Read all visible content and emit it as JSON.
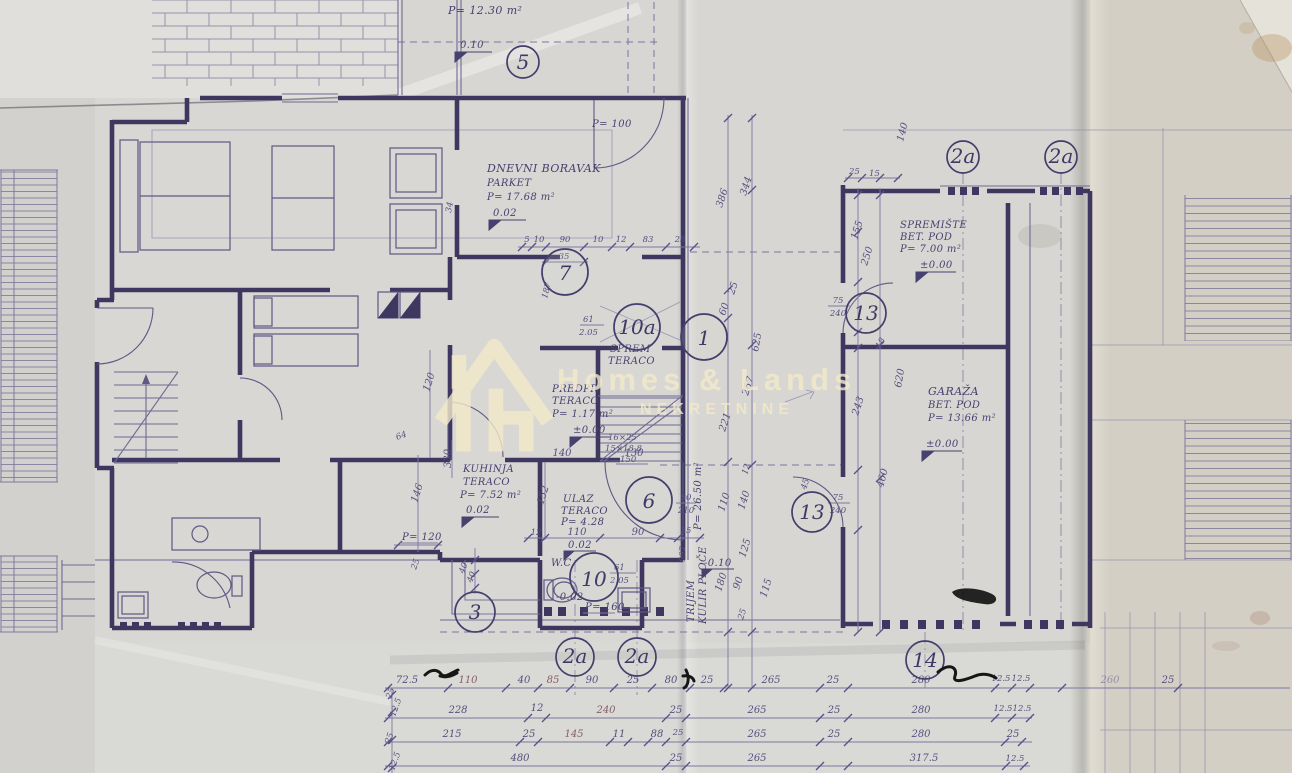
{
  "watermark": {
    "brand": "Homes & Lands",
    "subtitle": "NEKRETNINE",
    "color": "#f3eaca"
  },
  "plan": {
    "ink_color": "#3e3860",
    "paper_color": "#d7d6d2"
  },
  "rooms": {
    "attic": {
      "area": "P= 12.30 m²",
      "elev": "0.10"
    },
    "dnevni": {
      "name": "DNEVNI BORAVAK",
      "floor": "PARKET",
      "area": "P= 17.68 m²",
      "elev": "0.02",
      "note": "P= 100"
    },
    "sprem": {
      "name": "SPREM",
      "floor": "TERACO"
    },
    "predpr": {
      "name": "PREDPR",
      "floor": "TERACO",
      "area": "P= 1.17 m²",
      "elev": "±0.00"
    },
    "kuhinja": {
      "name": "KUHINJA",
      "floor": "TERACO",
      "area": "P= 7.52 m²",
      "elev": "0.02"
    },
    "ulaz": {
      "name": "ULAZ",
      "floor": "TERACO",
      "area": "P= 4.28",
      "elev": "0.02"
    },
    "wc": {
      "name": "W.C.",
      "elev": "-0.02",
      "door_w": "61",
      "door_h": "2.05",
      "note": "P= 160"
    },
    "trijem": {
      "name": "TRIJEM",
      "floor": "KULIR PLOČE",
      "area": "P= 26.50 m²",
      "elev": "-0.10"
    },
    "spremiste": {
      "name": "SPREMIŠTE",
      "floor": "BET. POD",
      "area": "P= 7.00 m²",
      "elev": "±0.00"
    },
    "garaza": {
      "name": "GARAŽA",
      "floor": "BET. POD",
      "area": "P= 13.66 m²",
      "elev": "±0.00"
    },
    "stairs": {
      "steps1": "16×25",
      "steps2": "15×18.8",
      "width": "150"
    },
    "door10a": {
      "w": "61",
      "h": "2.05"
    },
    "p120": "P= 120"
  },
  "markers": {
    "m5": "5",
    "m7": "7",
    "m10a": "10a",
    "m1": "1",
    "m6": "6",
    "m10": "10",
    "m3": "3",
    "m2a": "2a",
    "m13": "13",
    "m14": "14"
  },
  "dim_chains": {
    "bottom_row1": [
      "72.5",
      "110",
      "40",
      "85",
      "90",
      "25",
      "80",
      "25",
      "265",
      "25",
      "280",
      "12.5",
      "12.5",
      "260",
      "25"
    ],
    "bottom_row2": [
      "228",
      "12",
      "240",
      "25",
      "265",
      "25",
      "280",
      "12.5",
      "12.5"
    ],
    "bottom_row3": [
      "215",
      "25",
      "145",
      "11",
      "88",
      "25",
      "265",
      "25",
      "280",
      "25"
    ],
    "bottom_row4": [
      "480",
      "25",
      "265",
      "317.5",
      "12.5"
    ],
    "left_edge": [
      "25",
      "12.5",
      "25",
      "12.5"
    ],
    "top": [
      "5",
      "10",
      "90",
      "10",
      "12",
      "83",
      "25"
    ],
    "top_extra": "35",
    "left_vertical": [
      "386",
      "344",
      "25",
      "60",
      "625",
      "267",
      "221"
    ],
    "porch": [
      "90",
      "210",
      "092",
      "110",
      "140",
      "12",
      "125",
      "180",
      "90",
      "115",
      "25"
    ],
    "entry": [
      "140",
      "130",
      "152",
      "110",
      "90",
      "12",
      "25"
    ],
    "kitchen_left": [
      "330",
      "146",
      "120",
      "64",
      "187",
      "34"
    ],
    "garage": [
      "140",
      "25",
      "15",
      "155",
      "250",
      "75",
      "240",
      "18",
      "620",
      "243",
      "75",
      "240",
      "45",
      "460"
    ],
    "near_marker3": [
      "40",
      "40",
      "25"
    ]
  }
}
